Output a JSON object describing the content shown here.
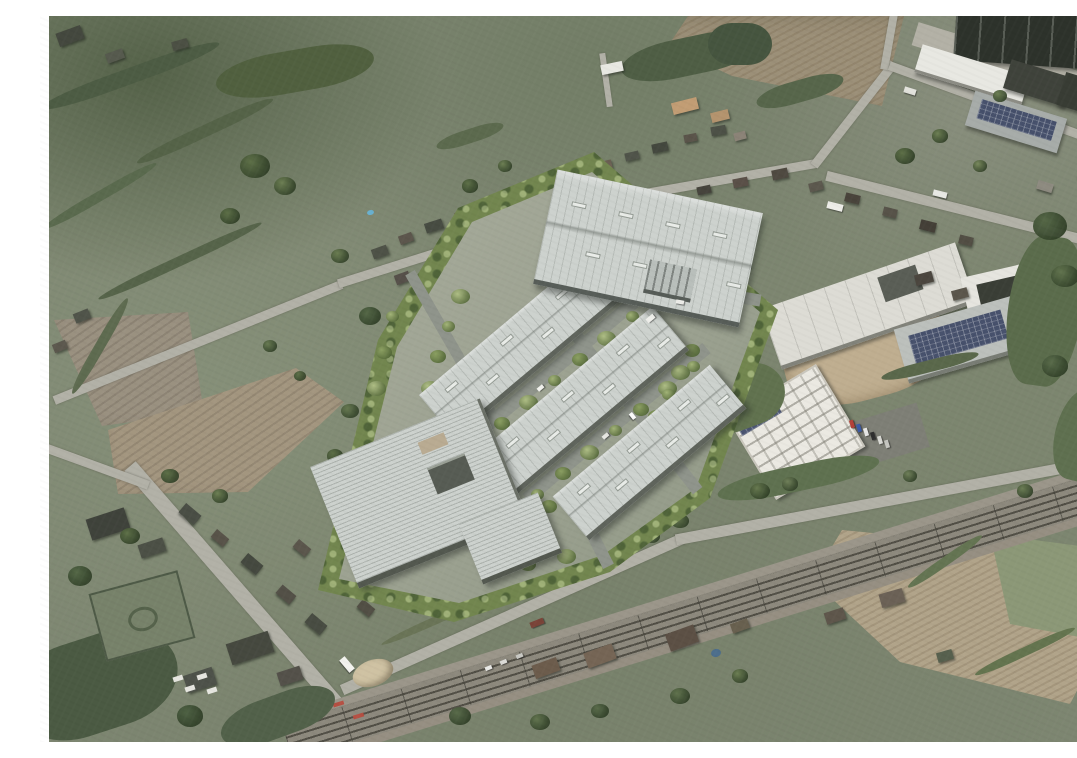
{
  "scene": {
    "caption": "Oblique aerial photomontage: CGI visualisation of a proposed industrial park with grey-roofed warehouse unit rows and tree-lined internal roads, set between a village to the north, ploughed fields to the west, an existing industrial estate to the east and a railway line with level crossing to the south",
    "view": "oblique-aerial",
    "development": {
      "unit_rows": 3,
      "large_warehouses": 2,
      "tree_belt": true,
      "internal_roads": true
    },
    "context": {
      "village_north": true,
      "ploughed_fields_west": 2,
      "ploughed_field_north": 1,
      "industrial_estate_east": true,
      "railway_line_south": true,
      "level_crossing": true,
      "large_tan_field_southeast": true
    },
    "palette": {
      "vegetation": "#7d8671",
      "woodland": "#4f5e45",
      "field_brown": "#9a9180",
      "field_tan": "#b1a48a",
      "new_roof": "#cdd2ce",
      "existing_dark_roof": "#2d322b",
      "white_roof": "#e8e8e2",
      "road": "#b2b1a7",
      "railway": "#8d897d",
      "frame": "#ffffff"
    }
  }
}
